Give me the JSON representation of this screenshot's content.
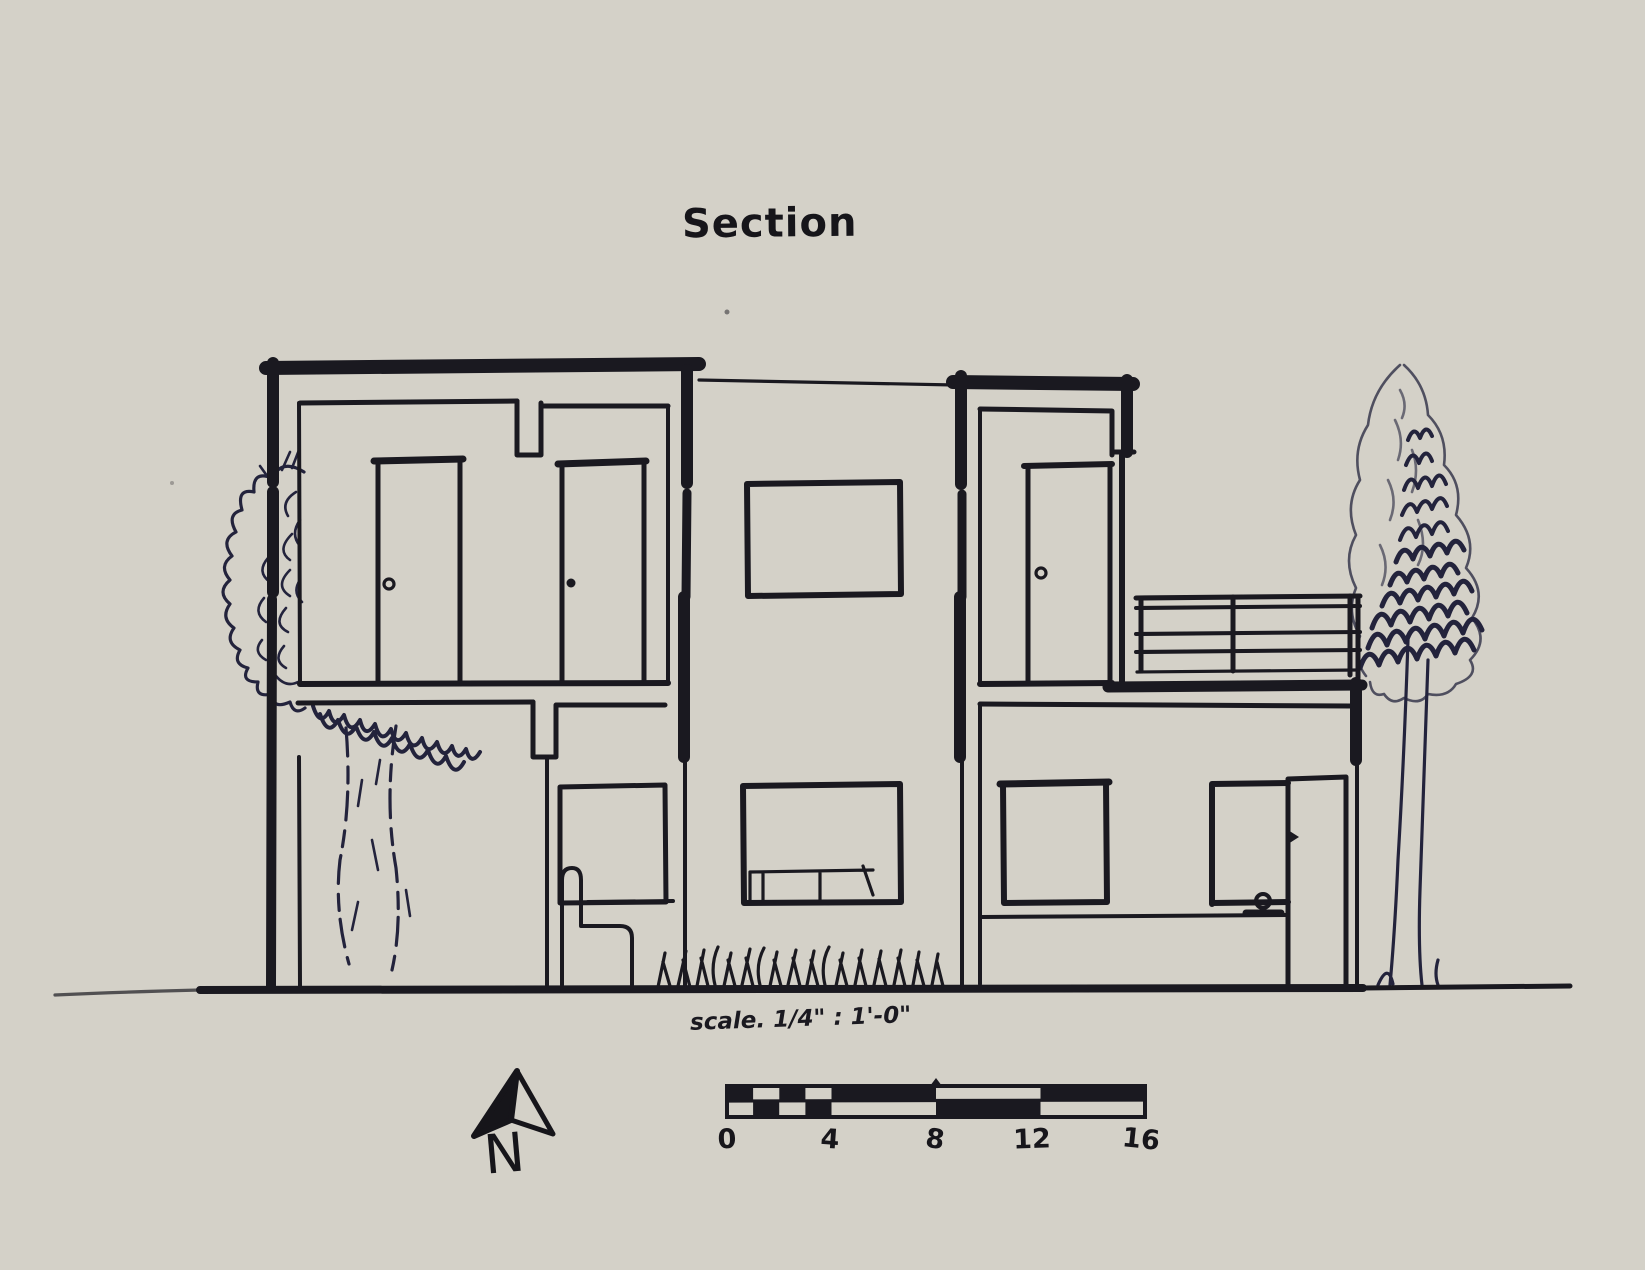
{
  "page": {
    "title": "Section",
    "background_color": "#d4d1c8",
    "ink_color": "#1a1920",
    "tree_ink_color": "#23233c"
  },
  "drawing": {
    "type": "hand-drawn architectural building section",
    "features": [
      "two-story sectioned house",
      "upper floor with two doors",
      "pilotis open ground floor with tree trunk",
      "armchair by lower window",
      "central elevation windows",
      "upper door onto balcony",
      "balcony railing",
      "lower floor windows and door",
      "ground line with grass",
      "tree left",
      "tree right"
    ]
  },
  "compass": {
    "icon": "north-arrow-icon",
    "label": "N"
  },
  "scale_bar": {
    "annotation": "scale. 1/4\" : 1'-0\"",
    "tick_labels": [
      "0",
      "4",
      "8",
      "12",
      "16"
    ]
  }
}
